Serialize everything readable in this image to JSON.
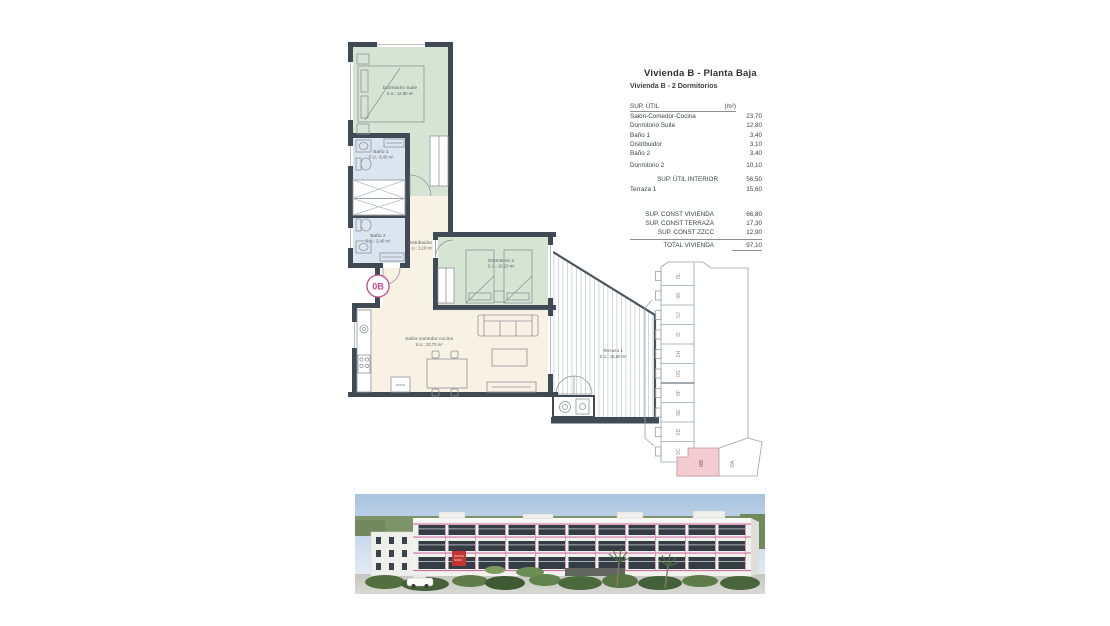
{
  "panel": {
    "title": "Vivienda B - Planta Baja",
    "subtitle": "Vivienda B - 2 Dormitorios",
    "col_label": "SUP. ÚTIL",
    "col_unit": "(m²)",
    "rows": [
      {
        "label": "Salón-Comedor-Cocina",
        "value": "23,70"
      },
      {
        "label": "Dormitorio Suite",
        "value": "12,80"
      },
      {
        "label": "Baño 1",
        "value": "3,40"
      },
      {
        "label": "Distribuidor",
        "value": "3,10"
      },
      {
        "label": "Baño 2",
        "value": "3,40"
      },
      {
        "label": "Dormitorio 2",
        "value": "10,10"
      }
    ],
    "interior_row": {
      "label": "SUP. ÚTIL INTERIOR",
      "value": "56,50"
    },
    "terraza_row": {
      "label": "Terraza 1",
      "value": "15,60"
    },
    "const_rows": [
      {
        "label": "SUP. CONST VIVIENDA",
        "value": "66,80"
      },
      {
        "label": "SUP. CONST TERRAZA",
        "value": "17,30"
      },
      {
        "label": "SUP. CONST ZZCC",
        "value": "12,90"
      }
    ],
    "total_row": {
      "label": "TOTAL VIVIENDA",
      "value": "97,10"
    }
  },
  "plan": {
    "unit_badge": "0B",
    "rooms": {
      "suite": {
        "name": "Dormitorio Suite",
        "area": "S.U.: 12,80 m²"
      },
      "bano1": {
        "name": "Baño 1",
        "area": "S.U.: 3,40 m²"
      },
      "bano2": {
        "name": "Baño 2",
        "area": "S.U.: 3,40 m²"
      },
      "distribuidor": {
        "name": "Distribuidor",
        "area": "S.U.: 3,10 m²"
      },
      "dorm2": {
        "name": "Dormitorio 2",
        "area": "S.U.: 10,10 m²"
      },
      "salon": {
        "name": "Salón-comedor-cocina",
        "area": "S.U.: 23,70 m²"
      },
      "terraza": {
        "name": "Terraza 1",
        "area": "S.U.: 15,60 m²"
      }
    },
    "appliance_label": "FRIGO",
    "colors": {
      "wall": "#3f4a54",
      "bedroom": "#d6e5d3",
      "bath": "#dbe5ef",
      "hall": "#f7f2e4",
      "badge": "#c2498f"
    }
  },
  "keyplan": {
    "units": [
      "0L",
      "0K",
      "0J",
      "0I",
      "0H",
      "0G",
      "0F",
      "0E",
      "0D",
      "0C"
    ],
    "highlight_unit": "0B",
    "adjacent_unit": "0A",
    "highlight_color": "#f2ccd1"
  },
  "render_colors": {
    "accent_line": "#cf6f9e",
    "sign": "#c23333"
  }
}
